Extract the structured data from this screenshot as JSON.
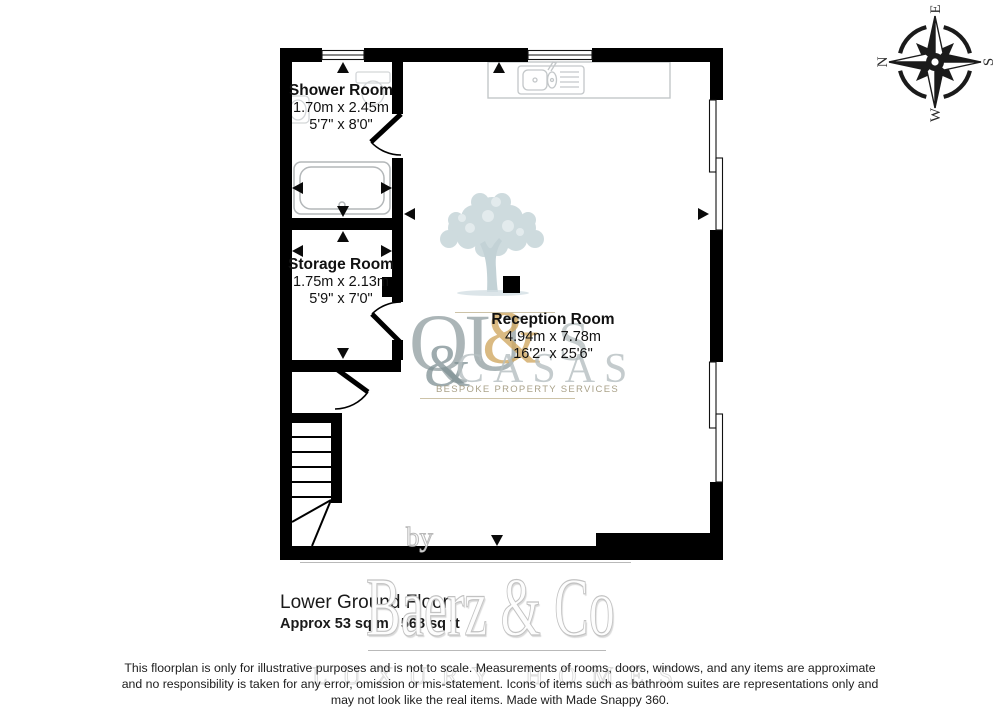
{
  "compass": {
    "north": "N",
    "east": "E",
    "south": "S",
    "west": "W"
  },
  "rooms": [
    {
      "name": "Shower Room",
      "metric": "1.70m x 2.45m",
      "imperial": "5'7\" x 8'0\""
    },
    {
      "name": "Storage Room",
      "metric": "1.75m x 2.13m",
      "imperial": "5'9\" x 7'0\""
    },
    {
      "name": "Reception Room",
      "metric": "4.94m x 7.78m",
      "imperial": "16'2\" x 25'6\""
    }
  ],
  "floor": {
    "title": "Lower Ground Floor",
    "area": "Approx 53 sq m / 568 sq ft"
  },
  "branding": {
    "by_label": "by",
    "brand_name": "Baerz & Co",
    "brand_tagline": "LUXURY HOMES",
    "logo_monogram_qu": "QU",
    "logo_monogram_amp1": "&",
    "logo_monogram_s": "S",
    "logo_monogram_amp2": "&",
    "logo_monogram_casas": "CASAS",
    "logo_tagline": "BESPOKE PROPERTY SERVICES"
  },
  "disclaimer": {
    "line1": "This floorplan is only for illustrative purposes and is not to scale. Measurements of rooms, doors, windows, and any items are approximate",
    "line2": "and no responsibility is taken for any error, omission or mis-statement. Icons of items such as bathroom suites are representations only and",
    "line3": "may not look like the real items. Made with Made Snappy 360."
  }
}
